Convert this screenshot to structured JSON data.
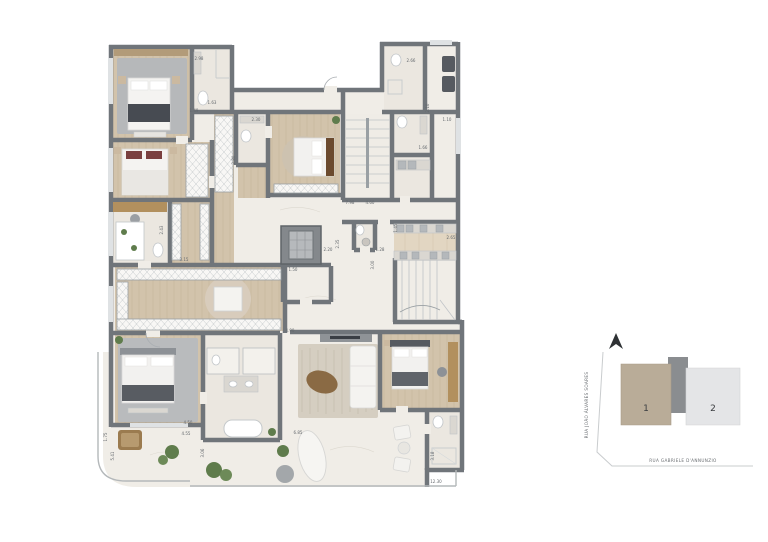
{
  "page": {
    "background": "#ffffff"
  },
  "plan": {
    "colors": {
      "wall": "#70757a",
      "wood_floor": "#d2c3ab",
      "marble_floor": "#ebe7e0",
      "stone_floor": "#f0ede7",
      "gray_rug": "#b7b9bb",
      "dark_textile": "#4a4e55",
      "plant_green": "#5f7c4c",
      "wardrobe_hatch": "#c3c7ca"
    },
    "dimensions": [
      {
        "t": "2.98",
        "x": 199,
        "y": 60,
        "r": 0
      },
      {
        "t": "1.49",
        "x": 194,
        "y": 112,
        "r": 0
      },
      {
        "t": "1.63",
        "x": 212,
        "y": 104,
        "r": 0
      },
      {
        "t": "2.30",
        "x": 256,
        "y": 121,
        "r": 0
      },
      {
        "t": "2.80",
        "x": 235,
        "y": 160,
        "r": -90
      },
      {
        "t": "2.66",
        "x": 411,
        "y": 62,
        "r": 0
      },
      {
        "t": "2.10",
        "x": 429,
        "y": 108,
        "r": -90
      },
      {
        "t": "1.10",
        "x": 447,
        "y": 121,
        "r": 0
      },
      {
        "t": "1.66",
        "x": 423,
        "y": 149,
        "r": 0
      },
      {
        "t": "7.98",
        "x": 350,
        "y": 204,
        "r": 0
      },
      {
        "t": "4.60",
        "x": 370,
        "y": 204,
        "r": 0
      },
      {
        "t": "1.45",
        "x": 397,
        "y": 228,
        "r": -90
      },
      {
        "t": "1.28",
        "x": 380,
        "y": 251,
        "r": 0
      },
      {
        "t": "3.00",
        "x": 374,
        "y": 265,
        "r": -90
      },
      {
        "t": "2.65",
        "x": 451,
        "y": 239,
        "r": 0
      },
      {
        "t": "2.20",
        "x": 328,
        "y": 251,
        "r": 0
      },
      {
        "t": "2.35",
        "x": 339,
        "y": 244,
        "r": -90
      },
      {
        "t": "1.50",
        "x": 293,
        "y": 271,
        "r": 0
      },
      {
        "t": "3.15",
        "x": 184,
        "y": 261,
        "r": 0
      },
      {
        "t": "2.43",
        "x": 163,
        "y": 230,
        "r": -90
      },
      {
        "t": "4.90",
        "x": 290,
        "y": 332,
        "r": 0
      },
      {
        "t": "4.50",
        "x": 188,
        "y": 424,
        "r": 0
      },
      {
        "t": "4.55",
        "x": 186,
        "y": 435,
        "r": 0
      },
      {
        "t": "1.75",
        "x": 107,
        "y": 437,
        "r": -90
      },
      {
        "t": "5.41",
        "x": 114,
        "y": 456,
        "r": -90
      },
      {
        "t": "3.06",
        "x": 204,
        "y": 453,
        "r": -90
      },
      {
        "t": "6.85",
        "x": 298,
        "y": 434,
        "r": 0
      },
      {
        "t": "3.18",
        "x": 434,
        "y": 456,
        "r": -90
      },
      {
        "t": "12.30",
        "x": 436,
        "y": 483,
        "r": 0
      }
    ]
  },
  "key_plan": {
    "units": [
      {
        "label": "1",
        "color": "#b9ac98"
      },
      {
        "label": "2",
        "color": "#e4e5e7"
      }
    ],
    "connector_color": "#8a8d90",
    "streets": {
      "left": "RUA JOÃO ÁLVARES SOARES",
      "bottom": "RUA GABRIELE D'ANNUNZIO"
    }
  }
}
